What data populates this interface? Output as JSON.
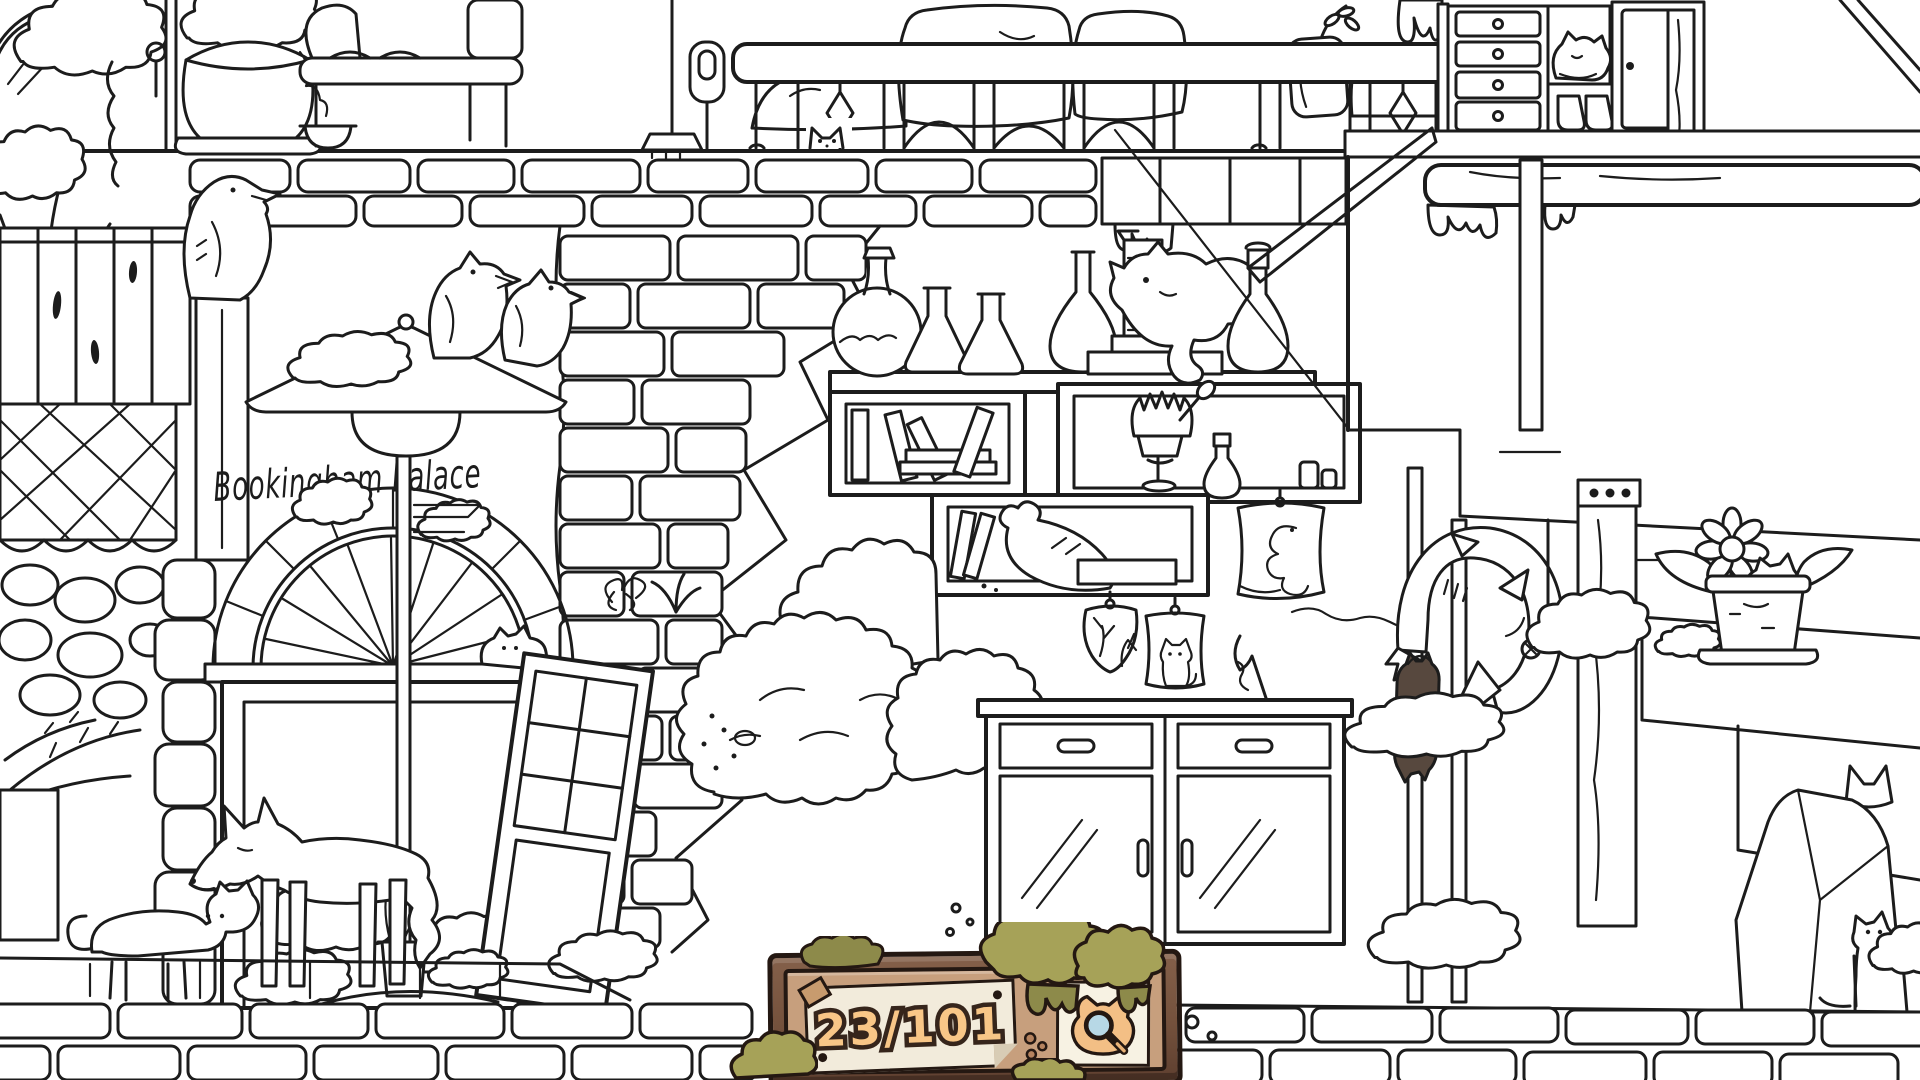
{
  "hud": {
    "counter": {
      "found": 23,
      "total": 101,
      "display": "23/101"
    },
    "magnifier": {
      "icon": "cat-magnifier-icon"
    }
  },
  "scene": {
    "sign_text": "Bookingham Palace",
    "description_items": {
      "ravens": "two ravens on street lamp, one raven on wooden post",
      "hidden_cats_visible": "cat peeking through balcony rail, cat sleeping in dresser cubby, cat statue on shelf, cat on arch ledge, walking cat with fox, colored cat hanging from fish sculpture, cat in flower pot, cat ears behind rock, sitting cat bottom right, cat drawing on poster"
    }
  },
  "colors": {
    "line": "#1c1c1c",
    "background": "#ffffff",
    "plaque_frame": "#74513c",
    "plaque_frame_outline": "#241812",
    "plaque_panel": "#c79f7d",
    "paper": "#f2ebdb",
    "counter_fill": "#f8c687",
    "counter_outline": "#36251b",
    "moss": "#a6a258",
    "moss_dark": "#8d8a4a",
    "magnifier_card": "#f7f2e3",
    "cat_icon_fur": "#f3bf85",
    "lens_blue": "#b7d8e6",
    "found_cat_body": "#57483e",
    "found_cat_belly": "#c9bcae",
    "pebble": "#b5835f"
  }
}
